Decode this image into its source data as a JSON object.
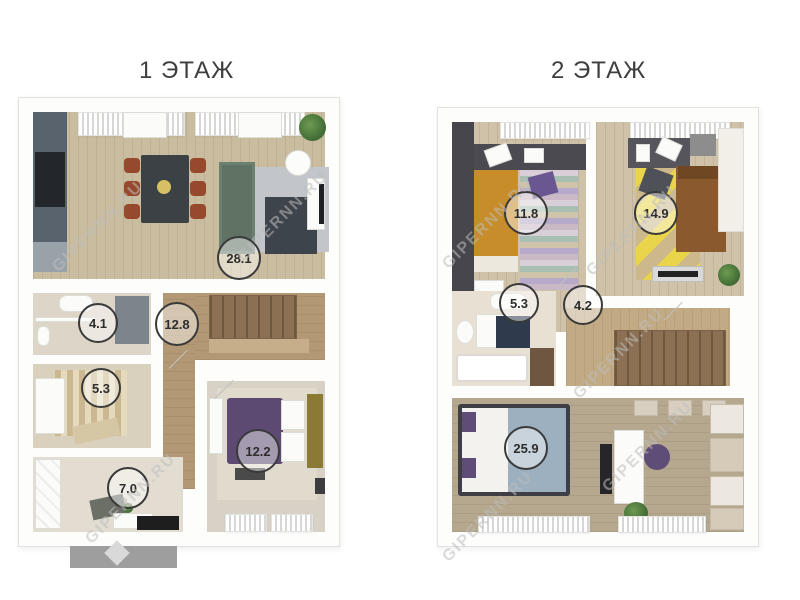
{
  "watermark": {
    "text": "GIPERNN.RU"
  },
  "floors": {
    "floor1": {
      "title": "1 ЭТАЖ",
      "rooms": {
        "living_kitchen": {
          "name": "living-kitchen",
          "area": "28.1"
        },
        "bathroom": {
          "name": "bathroom",
          "area": "4.1"
        },
        "hall": {
          "name": "hall-stairs",
          "area": "12.8"
        },
        "utility": {
          "name": "utility",
          "area": "5.3"
        },
        "entry": {
          "name": "entry",
          "area": "7.0"
        },
        "bedroom": {
          "name": "bedroom",
          "area": "12.2"
        }
      }
    },
    "floor2": {
      "title": "2 ЭТАЖ",
      "rooms": {
        "bedroom_left": {
          "name": "bedroom-left",
          "area": "11.8"
        },
        "bedroom_right": {
          "name": "bedroom-right",
          "area": "14.9"
        },
        "bathroom": {
          "name": "bathroom",
          "area": "5.3"
        },
        "hall": {
          "name": "hall-stairs",
          "area": "4.2"
        },
        "bedroom_big": {
          "name": "bedroom-big",
          "area": "25.9"
        }
      }
    }
  },
  "palette": {
    "floor_wood_light": "#cabd9f",
    "hall_wood": "#b29874",
    "stair_wood": "#8b7053",
    "kitchen_dark": "#59636d",
    "sofa_green": "#5f7264",
    "chair_brown": "#96492c",
    "bed_purple": "#5c4a72",
    "bed_orange": "#c78d2b",
    "bed_brown": "#8a5a2e",
    "duvet_blue": "#9db0bf",
    "rug_yellow": "#e9d44a",
    "wardrobe_charcoal": "#46464c",
    "porch_gray": "#9e9e9e",
    "label_text": "#2d2d2d"
  }
}
